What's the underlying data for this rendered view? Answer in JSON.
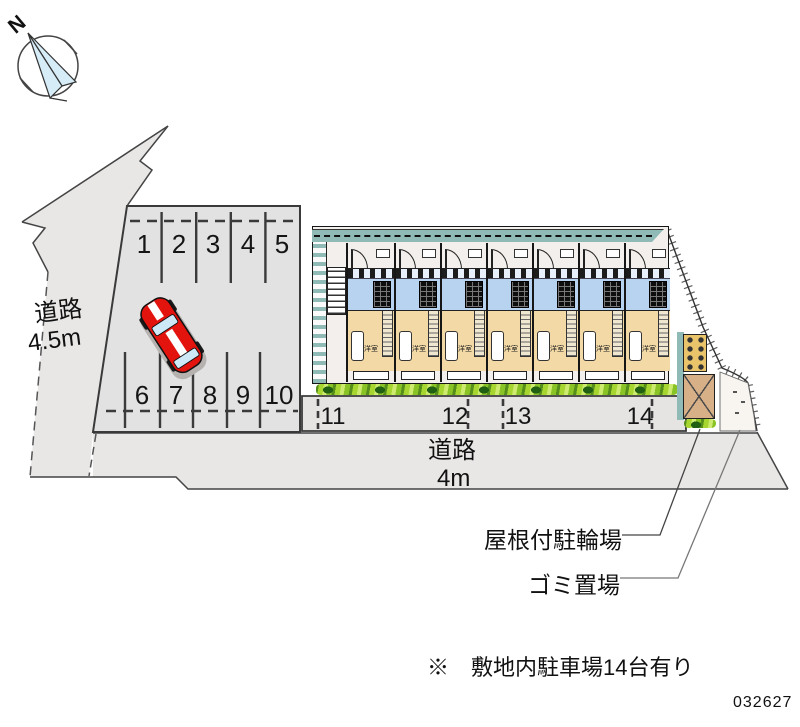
{
  "compass": {
    "north_label": "N"
  },
  "roads": {
    "left": {
      "label_line1": "道路",
      "label_line2": "4.5m"
    },
    "bottom": {
      "label_line1": "道路",
      "label_line2": "4m"
    }
  },
  "parking": {
    "row_top": [
      "1",
      "2",
      "3",
      "4",
      "5"
    ],
    "row_bottom": [
      "6",
      "7",
      "8",
      "9",
      "10"
    ],
    "row_street": [
      "11",
      "12",
      "13",
      "14"
    ]
  },
  "building": {
    "unit_label": "洋室",
    "unit_count": 7
  },
  "annotations": {
    "bicycle_parking_label": "屋根付駐輪場",
    "garbage_label": "ゴミ置場"
  },
  "footer": {
    "note": "※　敷地内駐車場14台有り",
    "plan_number": "032627"
  },
  "colors": {
    "road_fill": "#e9e7e6",
    "parking_fill": "#e3e2e2",
    "corridor_teal": "#8fbab6",
    "unit_blue": "#b7d3ef",
    "unit_tan": "#f3d9a5",
    "hedge_green": "#a6d62f",
    "car_red": "#e3130e",
    "compass_blue": "#d6ecf7"
  }
}
